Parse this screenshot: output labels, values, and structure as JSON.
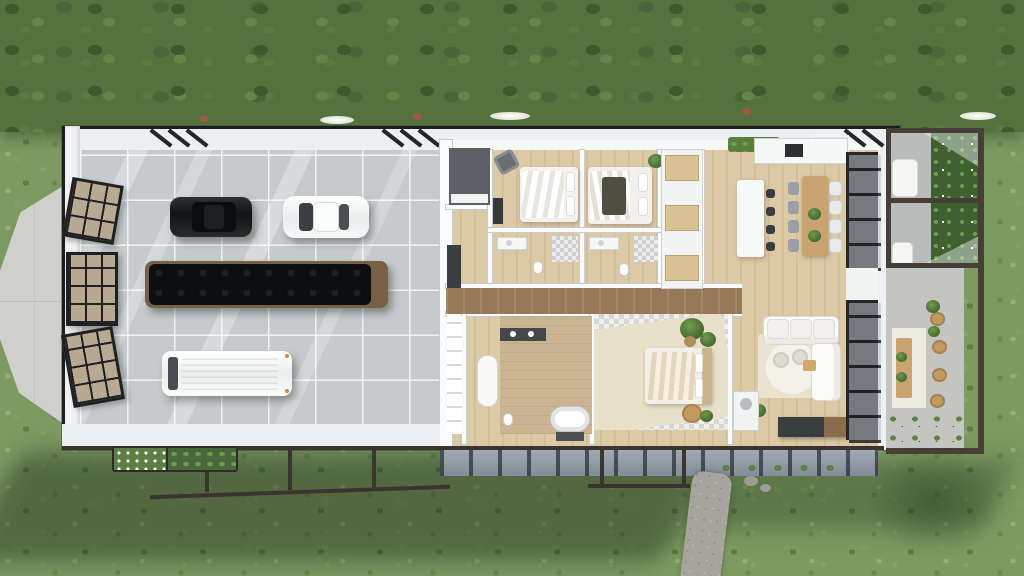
{
  "scene": {
    "type": "aerial-3d-floorplan-render",
    "title": "Top-down 3D render of a single-storey barn-style house with attached garage on a grass lawn",
    "text_on_screen": [],
    "palette": {
      "grass": "#7d9a62",
      "tree_band": "#54713e",
      "roof_edge": "#1c1e1f",
      "wall_white": "#f1f2f3",
      "garage_floor": "#c7cacd",
      "wood_floor": "#dcc9a5",
      "hall_wood": "#97795a",
      "door_glass_tan": "#b7a992",
      "frame_black": "#1f2022",
      "suv_black": "#121416",
      "coupe_white": "#f4f5f6",
      "van_white": "#f6f6f4",
      "boat_cover_black": "#0d0e0f",
      "boat_trim_wood": "#776045",
      "checker_tile": "#d6d6d4",
      "concrete_deck": "#c4c5c1",
      "gravel_path": "#a6a59d",
      "planting_green": "#4e7a3a",
      "pergola_beam": "#473e36"
    },
    "rooms": {
      "garage": "three-bay garage with tiled concrete floor and skylight shafts",
      "office": "dark-floored office nook",
      "bedroom1": "bedroom with white double bed and armchair",
      "bedroom2": "bedroom with white double bed and dark throw",
      "bath_strip": "jack-and-jill bathrooms with vanities and checker showers",
      "hallway": "central walnut-wood hallway",
      "walk_in_closet": "walk-in closet with shelf wall and oval bench",
      "master_bath": "master bathroom with dark double vanity and freestanding tub",
      "master_bedroom": "master bedroom with checkered floor, cream rug and bed",
      "pantry": "pantry / wardrobe hall with timber shelves",
      "kitchen": "kitchen with white island, cooktop counter and four stools",
      "dining": "timber dining table with eight chairs and two plants",
      "living": "living room with white L sectional, round rug and media console"
    },
    "outdoor": {
      "west_apron": "pointed concrete apron outside garage barn doors",
      "barn_doors": "three black-grid glazed barn doors, two swung open",
      "side_courtyard": "pergola-framed courtyard with lounge chairs, garden bed and glass sails",
      "east_deck": "outdoor dining deck with timber table, wicker chairs and planters",
      "south_planters": "flower and shrub planter boxes along south frame",
      "gravel_path": "curved gravel footpath leading from the south deck",
      "under_frame": "exposed dark steel sub-frame and posts below the slab"
    },
    "vehicles": [
      {
        "name": "black-suv",
        "color": "#121416"
      },
      {
        "name": "white-coupe",
        "color": "#f4f5f6"
      },
      {
        "name": "covered-boat",
        "color": "#0d0e0f"
      },
      {
        "name": "white-van",
        "color": "#f6f6f4"
      }
    ],
    "counts": {
      "barn_doors": 3,
      "kitchen_stools": 4,
      "dining_chairs": 8,
      "bedrooms": 3,
      "vehicles": 4
    }
  }
}
